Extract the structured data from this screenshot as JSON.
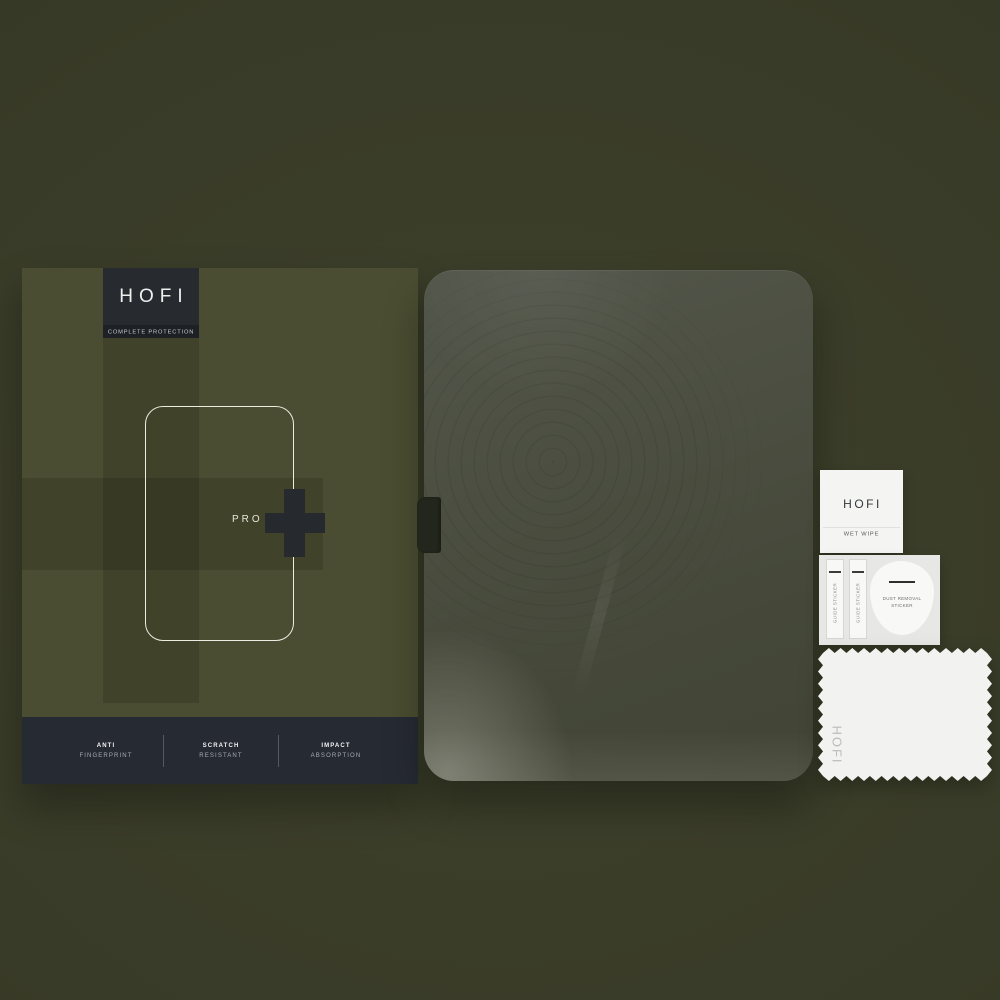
{
  "colors": {
    "background": "#383b27",
    "box_olive": "#4a4d31",
    "panel_dark": "#262a33",
    "glass_gray_green": "#4b4e40",
    "accessory_white": "#f4f4f2",
    "outline_cream": "#efebe0"
  },
  "box": {
    "brand": "HOFI",
    "tagline": "COMPLETE PROTECTION",
    "model_label": "PRO",
    "plus_symbol": "+",
    "features": [
      {
        "line1": "ANTI",
        "line2": "FINGERPRINT"
      },
      {
        "line1": "SCRATCH",
        "line2": "RESISTANT"
      },
      {
        "line1": "IMPACT",
        "line2": "ABSORPTION"
      }
    ]
  },
  "kit": {
    "wet_wipe": {
      "brand": "HOFI",
      "label": "WET WIPE"
    },
    "guide_sticker_1": {
      "label": "GUIDE STICKER"
    },
    "guide_sticker_2": {
      "label": "GUIDE STICKER"
    },
    "dust_removal": {
      "label": "DUST REMOVAL STICKER"
    },
    "cloth": {
      "brand": "HOFI"
    }
  }
}
